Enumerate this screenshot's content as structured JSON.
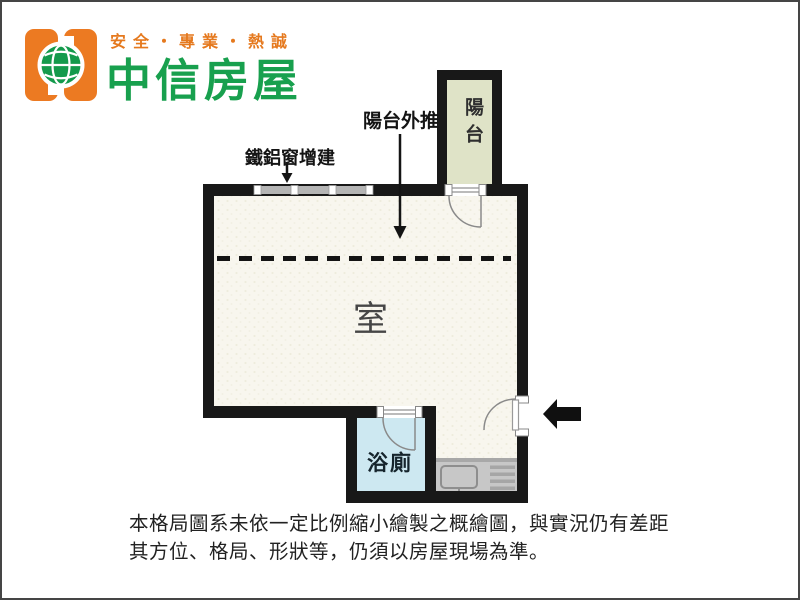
{
  "brand": {
    "slogan": "安全・專業・熱誠",
    "name": "中信房屋",
    "colors": {
      "logo_orange": "#ec7a22",
      "logo_green": "#149a4c",
      "slogan_orange": "#e5791e",
      "name_green": "#18a04e"
    }
  },
  "floorplan": {
    "annotations": {
      "balcony_pushout": "陽台外推",
      "window_addition": "鐵鋁窗增建"
    },
    "rooms": {
      "balcony": "陽台",
      "main_room": "室",
      "bathroom": "浴廁"
    },
    "icons": {
      "entrance-arrow": "left-pointing solid black arrow at entry door",
      "pushout-arrow": "long down arrow from 陽台外推 label",
      "window-arrow": "short down arrow from 鐵鋁窗增建 label",
      "globe-icon": "green globe in brand logo"
    },
    "colors": {
      "wall": "#181818",
      "main_floor": "#f8f6ee",
      "balcony_floor": "#dfe3c7",
      "bathroom_floor": "#cde8f1",
      "counter_gray": "#c7c7c7",
      "window_band_gray": "#b5b5b5",
      "door_swing_gray": "#8a8a8a"
    }
  },
  "disclaimer": {
    "line1": "本格局圖系未依一定比例縮小繪製之概繪圖，與實況仍有差距",
    "line2": "其方位、格局、形狀等，仍須以房屋現場為準。"
  }
}
